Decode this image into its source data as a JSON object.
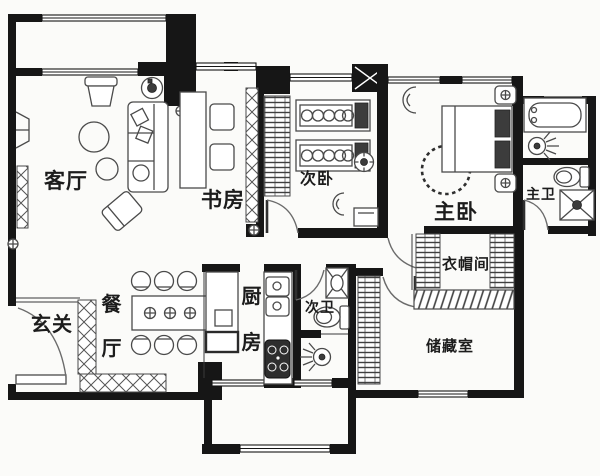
{
  "plan": {
    "labels": {
      "living": "客厅",
      "study": "书房",
      "bedroom2": "次卧",
      "master": "主卧",
      "master_bath": "主卫",
      "cloakroom": "衣帽间",
      "storage": "储藏室",
      "entry": "玄关",
      "dining": "餐厅",
      "kitchen": "厨房",
      "bath2": "次卫"
    },
    "colors": {
      "wall": "#161616",
      "furniture_line": "#4a4a4a",
      "text": "#1c1c1c",
      "background": "#fbfbf9"
    }
  }
}
